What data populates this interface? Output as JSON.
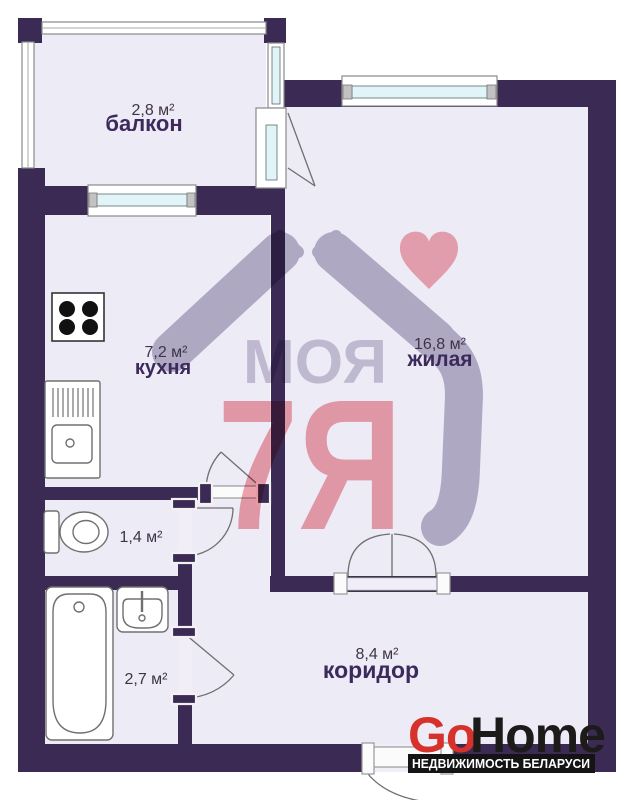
{
  "watermark": {
    "line1": "МОЯ",
    "line2": "7Я"
  },
  "rooms": {
    "balcony": {
      "name": "балкон",
      "area": "2,8 м²"
    },
    "kitchen": {
      "name": "кухня",
      "area": "7,2 м²"
    },
    "living": {
      "name": "жилая",
      "area": "16,8 м²"
    },
    "toilet": {
      "area": "1,4 м²"
    },
    "bathroom": {
      "area": "2,7 м²"
    },
    "corridor": {
      "name": "коридор",
      "area": "8,4 м²"
    }
  },
  "logo": {
    "part1": "Go",
    "part2": "Home",
    "tagline": "НЕДВИЖИМОСТЬ БЕЛАРУСИ"
  },
  "colors": {
    "wall": "#3b2a54",
    "room_fill": "#edebf5",
    "watermark_gray": "#b7b0c7",
    "watermark_pink": "#ef9ba5",
    "heart_pink": "#f2a3ac",
    "glass": "#e1f5f8",
    "logo_red": "#d7312c",
    "logo_dark": "#1d1b1a",
    "label_purple": "#3d2a5c"
  }
}
